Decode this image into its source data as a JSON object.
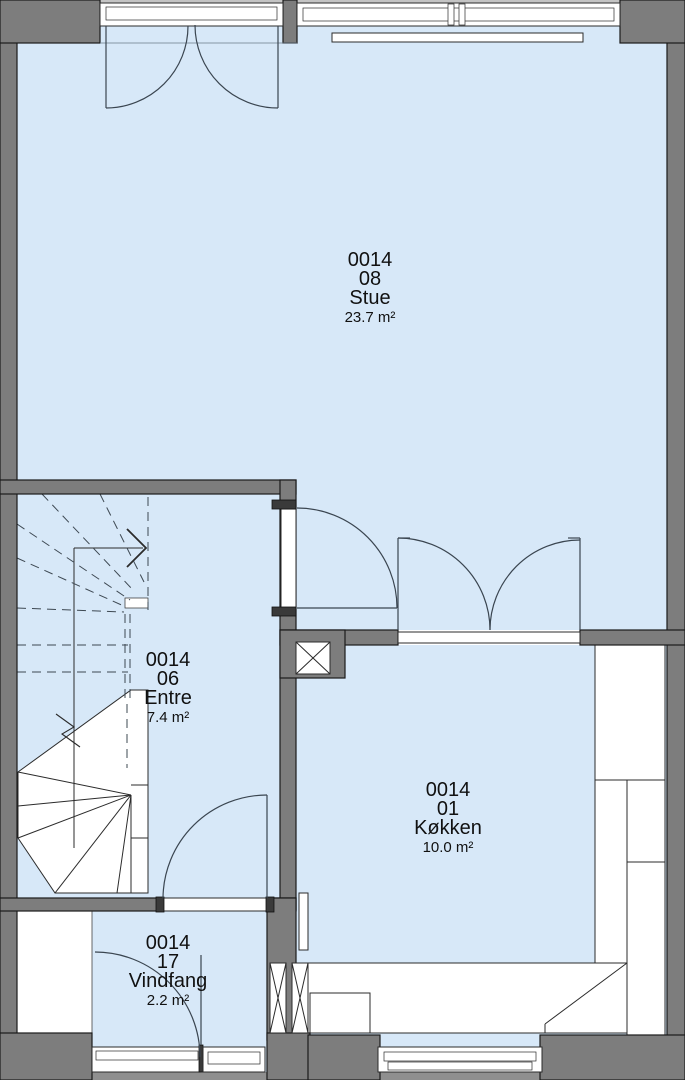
{
  "plan": {
    "rooms": [
      {
        "id": "0014",
        "number": "08",
        "name": "Stue",
        "area": "23.7 m²"
      },
      {
        "id": "0014",
        "number": "06",
        "name": "Entre",
        "area": "7.4 m²"
      },
      {
        "id": "0014",
        "number": "01",
        "name": "Køkken",
        "area": "10.0 m²"
      },
      {
        "id": "0014",
        "number": "17",
        "name": "Vindfang",
        "area": "2.2 m²"
      }
    ],
    "colors": {
      "wall": "#7d7d7d",
      "floor": "#d7e8f8",
      "outline": "#1a1a1a",
      "dashed": "#3d4852"
    }
  }
}
